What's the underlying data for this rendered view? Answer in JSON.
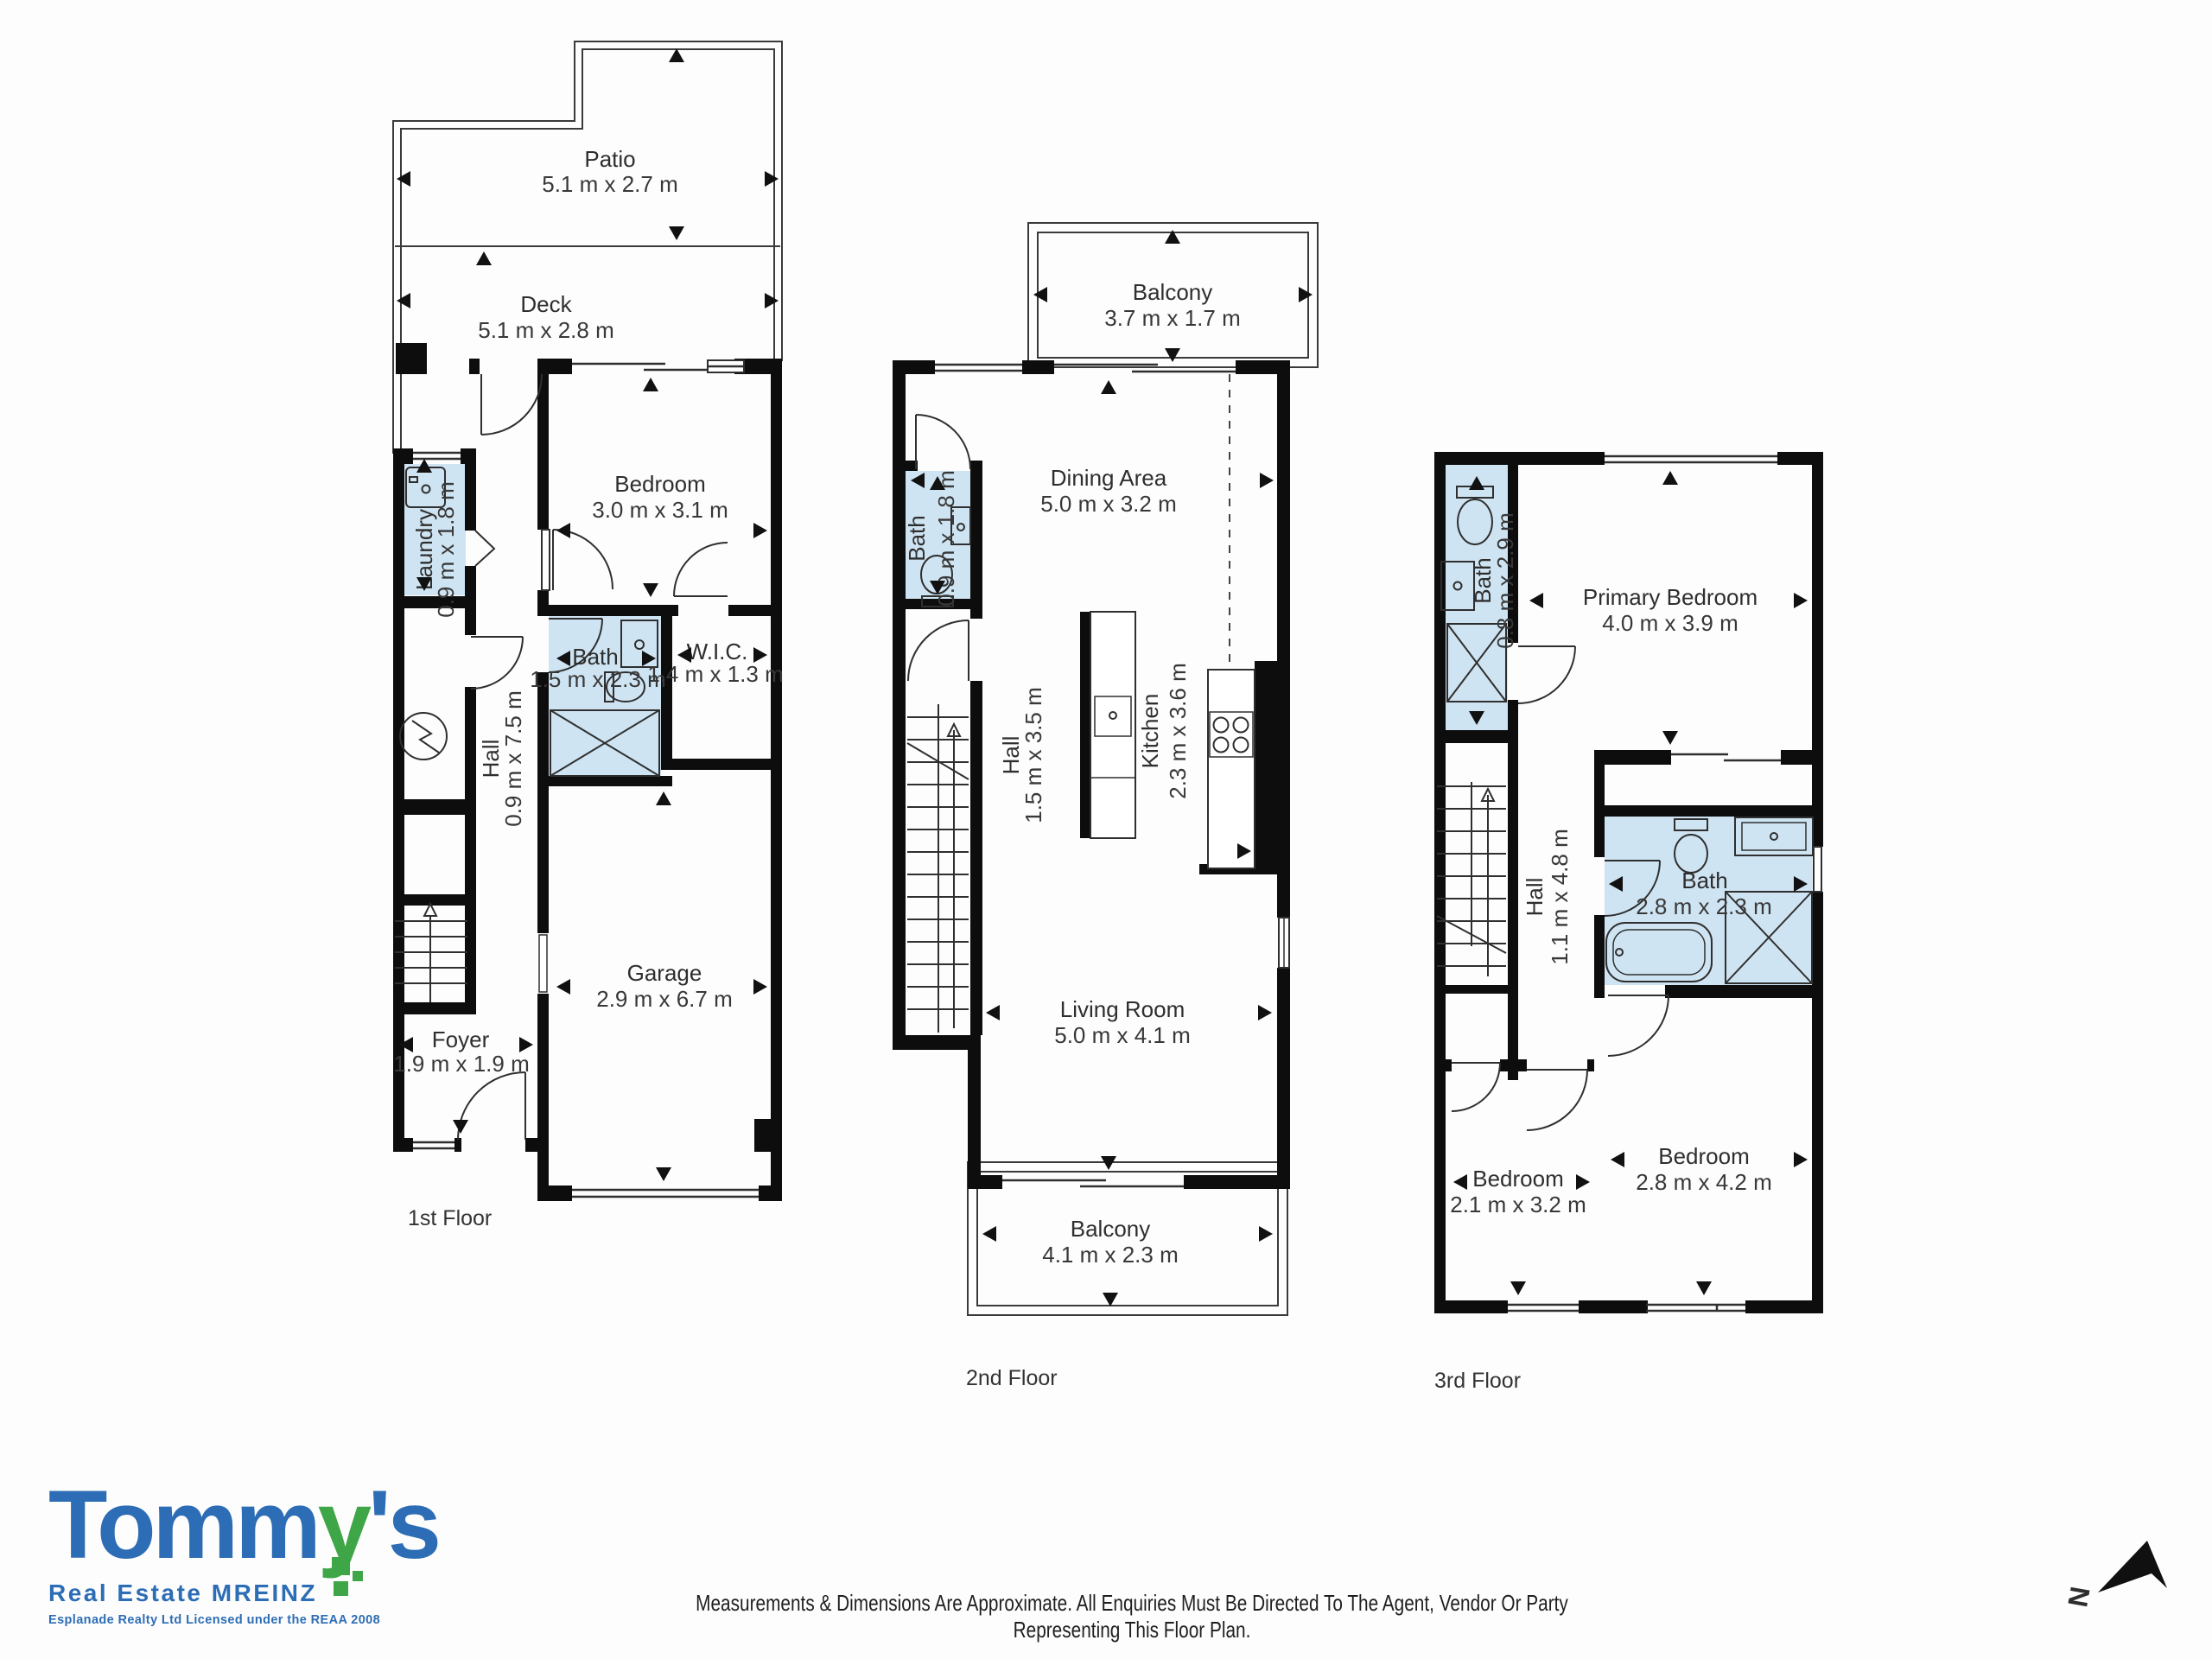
{
  "floors": [
    {
      "label": "1st Floor",
      "rooms": {
        "patio": {
          "name": "Patio",
          "dims": "5.1 m x 2.7 m"
        },
        "deck": {
          "name": "Deck",
          "dims": "5.1 m x 2.8 m"
        },
        "bedroom": {
          "name": "Bedroom",
          "dims": "3.0 m x 3.1 m"
        },
        "laundry": {
          "name": "Laundry",
          "dims": "0.9 m x 1.8 m"
        },
        "bath": {
          "name": "Bath",
          "dims": "1.5 m x 2.3 m"
        },
        "wic": {
          "name": "W.I.C.",
          "dims": "1.4 m x 1.3 m"
        },
        "hall": {
          "name": "Hall",
          "dims": "0.9 m x 7.5 m"
        },
        "garage": {
          "name": "Garage",
          "dims": "2.9 m x 6.7 m"
        },
        "foyer": {
          "name": "Foyer",
          "dims": "1.9 m x 1.9 m"
        }
      }
    },
    {
      "label": "2nd Floor",
      "rooms": {
        "balcony_top": {
          "name": "Balcony",
          "dims": "3.7 m x 1.7 m"
        },
        "dining": {
          "name": "Dining Area",
          "dims": "5.0 m x 3.2 m"
        },
        "bath": {
          "name": "Bath",
          "dims": "0.9 m x 1.8 m"
        },
        "hall": {
          "name": "Hall",
          "dims": "1.5 m x 3.5 m"
        },
        "kitchen": {
          "name": "Kitchen",
          "dims": "2.3 m x 3.6 m"
        },
        "living": {
          "name": "Living Room",
          "dims": "5.0 m x 4.1 m"
        },
        "balcony_bottom": {
          "name": "Balcony",
          "dims": "4.1 m x 2.3 m"
        }
      }
    },
    {
      "label": "3rd Floor",
      "rooms": {
        "bath_small": {
          "name": "Bath",
          "dims": "0.8 m x 2.9 m"
        },
        "primary": {
          "name": "Primary Bedroom",
          "dims": "4.0 m x 3.9 m"
        },
        "hall": {
          "name": "Hall",
          "dims": "1.1 m x 4.8 m"
        },
        "bath": {
          "name": "Bath",
          "dims": "2.8 m x 2.3 m"
        },
        "bedroom_small": {
          "name": "Bedroom",
          "dims": "2.1 m x 3.2 m"
        },
        "bedroom_large": {
          "name": "Bedroom",
          "dims": "2.8 m x 4.2 m"
        }
      }
    }
  ],
  "branding": {
    "word_start": "Tomm",
    "word_accent": "y",
    "word_end": "'s",
    "tagline": "Real Estate MREINZ",
    "license": "Esplanade Realty Ltd Licensed under the REAA 2008",
    "blue": "#2d6db5",
    "green": "#3fa648"
  },
  "disclaimer": "Measurements & Dimensions Are Approximate. All Enquiries Must Be Directed To The Agent, Vendor Or Party Representing This Floor Plan.",
  "compass": {
    "label": "N"
  },
  "palette": {
    "wall": "#0d0d0d",
    "wet_area": "#cfe4f2",
    "line": "#3a3a3a",
    "text": "#2e2e2e",
    "background": "#fdfdfd"
  }
}
